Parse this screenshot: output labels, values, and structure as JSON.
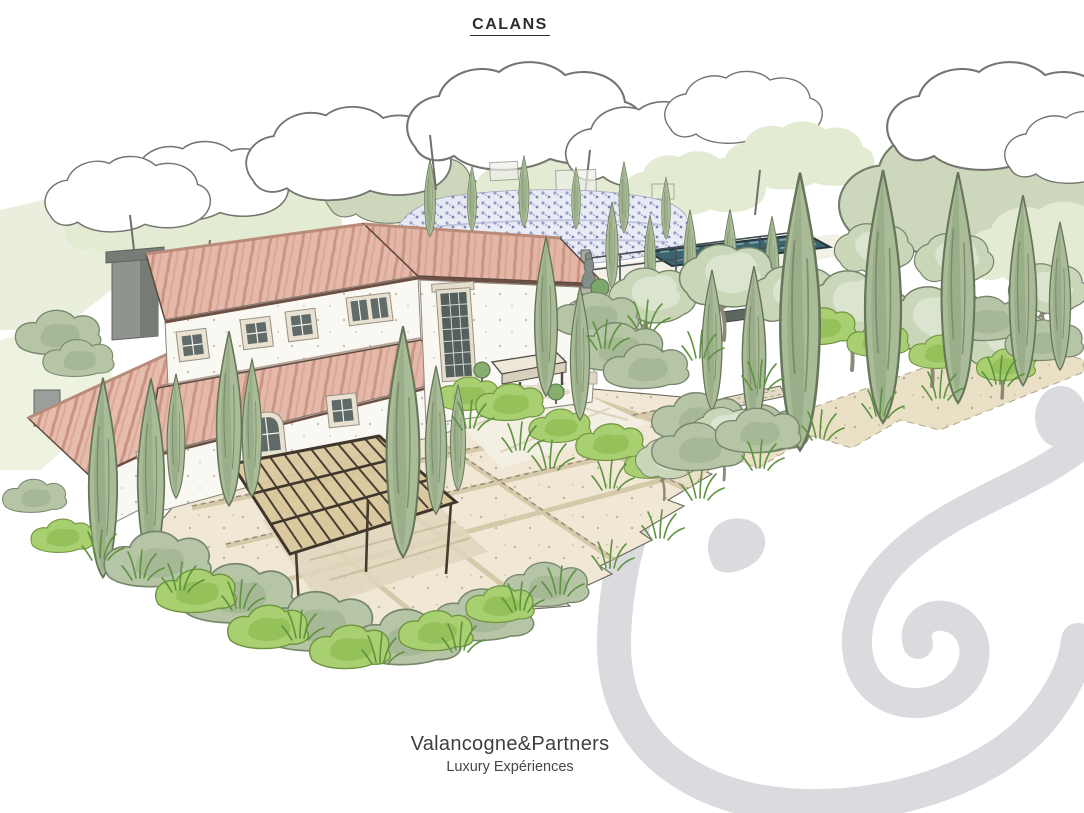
{
  "title": "CALANS",
  "footer": {
    "brand": "Valancogne&Partners",
    "tagline": "Luxury Expériences"
  },
  "scene": {
    "type": "hand-drawn architectural perspective sketch",
    "features": [
      "two-storey farmhouse with terracotta roofs",
      "stone chimney",
      "cypress trees",
      "olive trees",
      "lavender field",
      "fenced swimming pool",
      "metal pergola terrace",
      "stone-paved courtyard",
      "gravel path",
      "garden shrubs and grasses",
      "statue at house corner",
      "stone bench",
      "ampersand swirl watermark"
    ],
    "colors": {
      "paper": "#ffffff",
      "ink": "#55534e",
      "roof": "#e5b9aa",
      "roof_streak": "#c68e7c",
      "wall": "#f9f8f3",
      "chimney": "#8f948e",
      "cypress": "#a9bc97",
      "olive": "#c9d6b8",
      "shrub_bright": "#a8cf70",
      "shrub_sage": "#b6c5a6",
      "paving": "#f0e8d5",
      "paving_band": "#d6c9a9",
      "gravel": "#eae0c5",
      "terrace": "#f3efe3",
      "pool_water": "#3c6570",
      "lavender": "#8d95c4",
      "pergola_canvas": "#d9c69c",
      "pergola_frame": "#453b2f",
      "watermark": "#dbdbdf"
    }
  }
}
